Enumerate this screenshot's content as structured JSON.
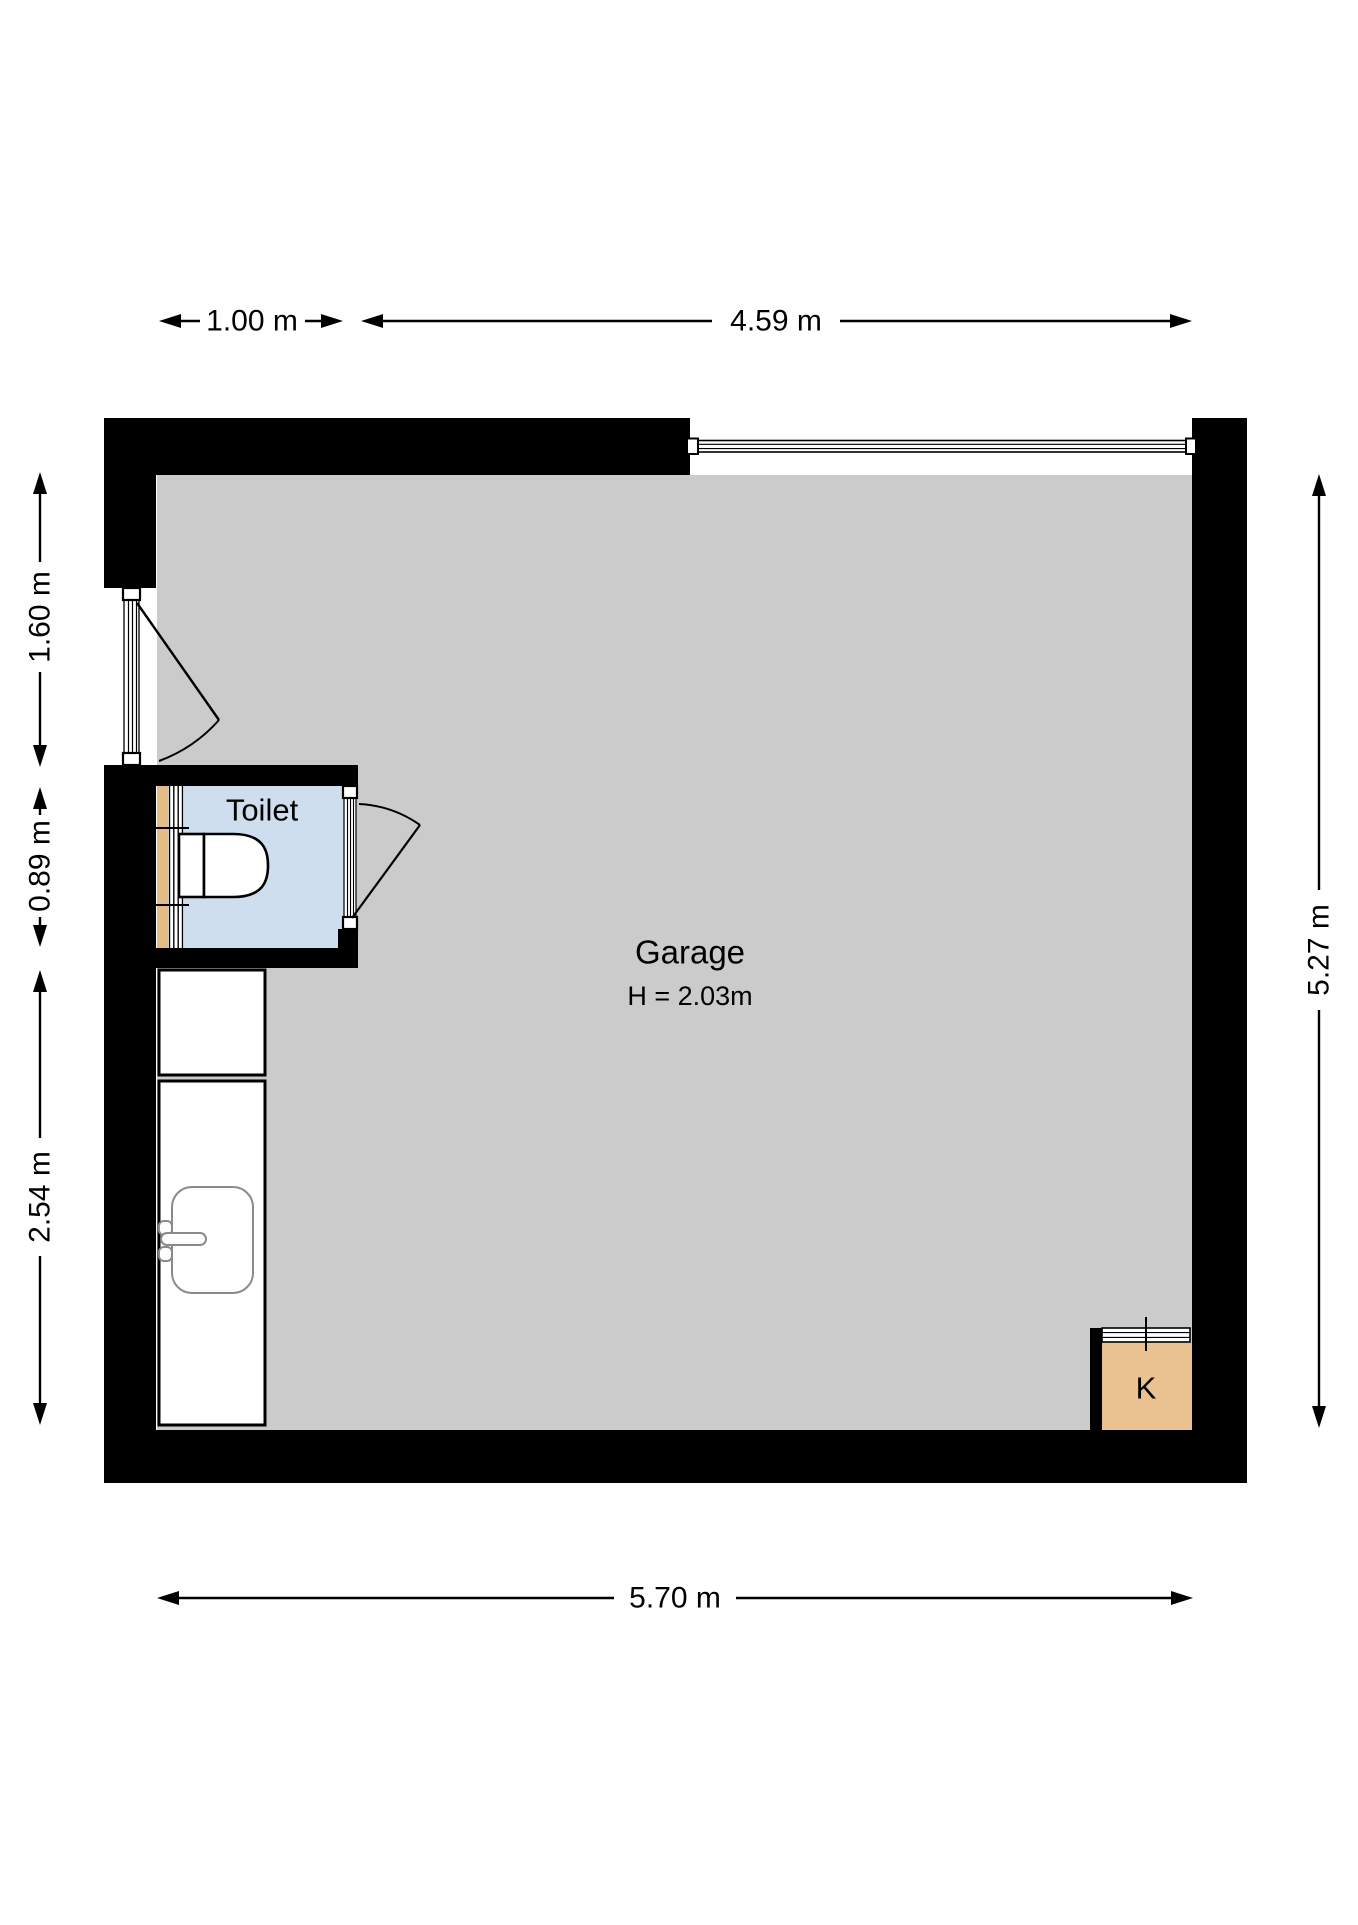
{
  "plan": {
    "title": "Garage floor plan",
    "rooms": {
      "garage": {
        "label": "Garage",
        "height_label": "H = 2.03m"
      },
      "toilet": {
        "label": "Toilet"
      },
      "kitchenette": {
        "label": "K"
      }
    },
    "dimensions": {
      "top_left": {
        "label": "1.00 m"
      },
      "top_right": {
        "label": "4.59 m"
      },
      "left_upper": {
        "label": "1.60 m"
      },
      "left_middle": {
        "label": "0.89 m"
      },
      "left_lower": {
        "label": "2.54 m"
      },
      "right": {
        "label": "5.27 m"
      },
      "bottom": {
        "label": "5.70 m"
      }
    },
    "colors": {
      "wall": "#000000",
      "garage_floor": "#cbcbcb",
      "toilet_floor": "#cfdeee",
      "k_floor": "#eac28f",
      "sill": "#e6bc85",
      "fixture_stroke": "#8a8a8a",
      "dimension": "#000000"
    }
  }
}
